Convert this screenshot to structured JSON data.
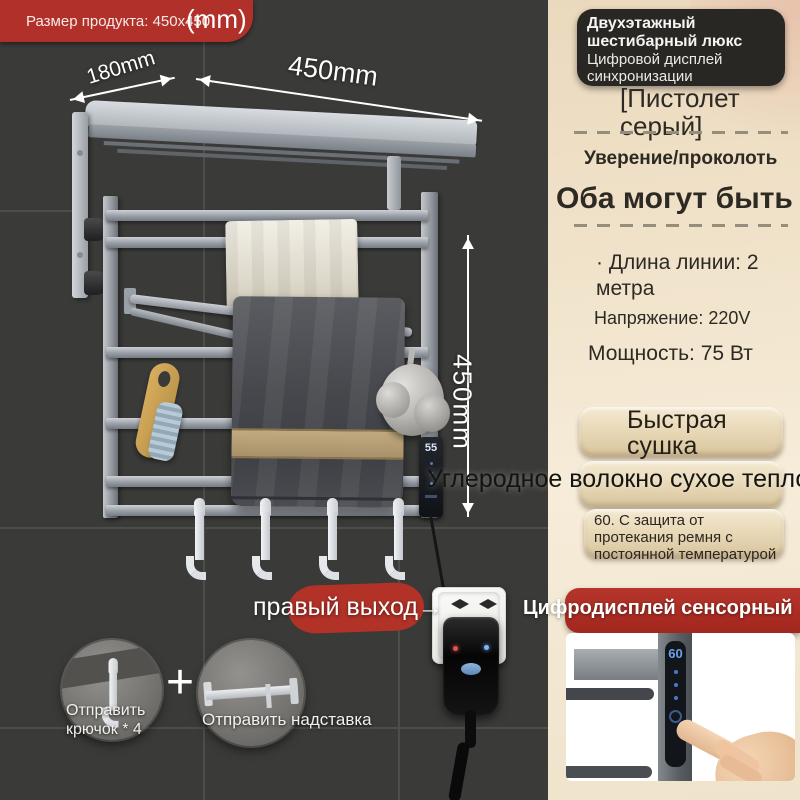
{
  "size_badge": {
    "text": "Размер продукта: 450x450",
    "unit": "(mm)"
  },
  "dimensions": {
    "depth": "180mm",
    "width": "450mm",
    "height": "450mm"
  },
  "rack_display": {
    "value": "55"
  },
  "carbon_line": "Углеродное волокно сухое тепло",
  "outlet_note": "правый выход→",
  "insets": {
    "plus": "+",
    "hook_label": "Отправить крючок * 4",
    "bar_label": "Отправить надставка"
  },
  "panel": {
    "header": {
      "title": "Двухэтажный шестибарный люкс",
      "subtitle": "Цифровой дисплей синхронизации"
    },
    "variant": "[Пистолет серый]",
    "assurance": "Уверение/проколоть",
    "both_line": "Оба могут быть",
    "specs": {
      "cord": "·  Длина линии: 2 метра",
      "voltage": "Напряжение: 220V",
      "power": "Мощность: 75 Вт"
    },
    "features": {
      "fast_dry": "Быстрая сушка",
      "protection": "60. С защита от протекания ремня с постоянной температурой"
    },
    "banner": "Цифродисплей сенсорный",
    "touch_display": {
      "value": "60"
    }
  },
  "colors": {
    "accent_red": "#b13029",
    "panel_cream": "#f1e5cd",
    "wall_dark": "#3a3a38",
    "button_beige": "#e6d6b4",
    "display_blue": "#6fa0f0"
  }
}
